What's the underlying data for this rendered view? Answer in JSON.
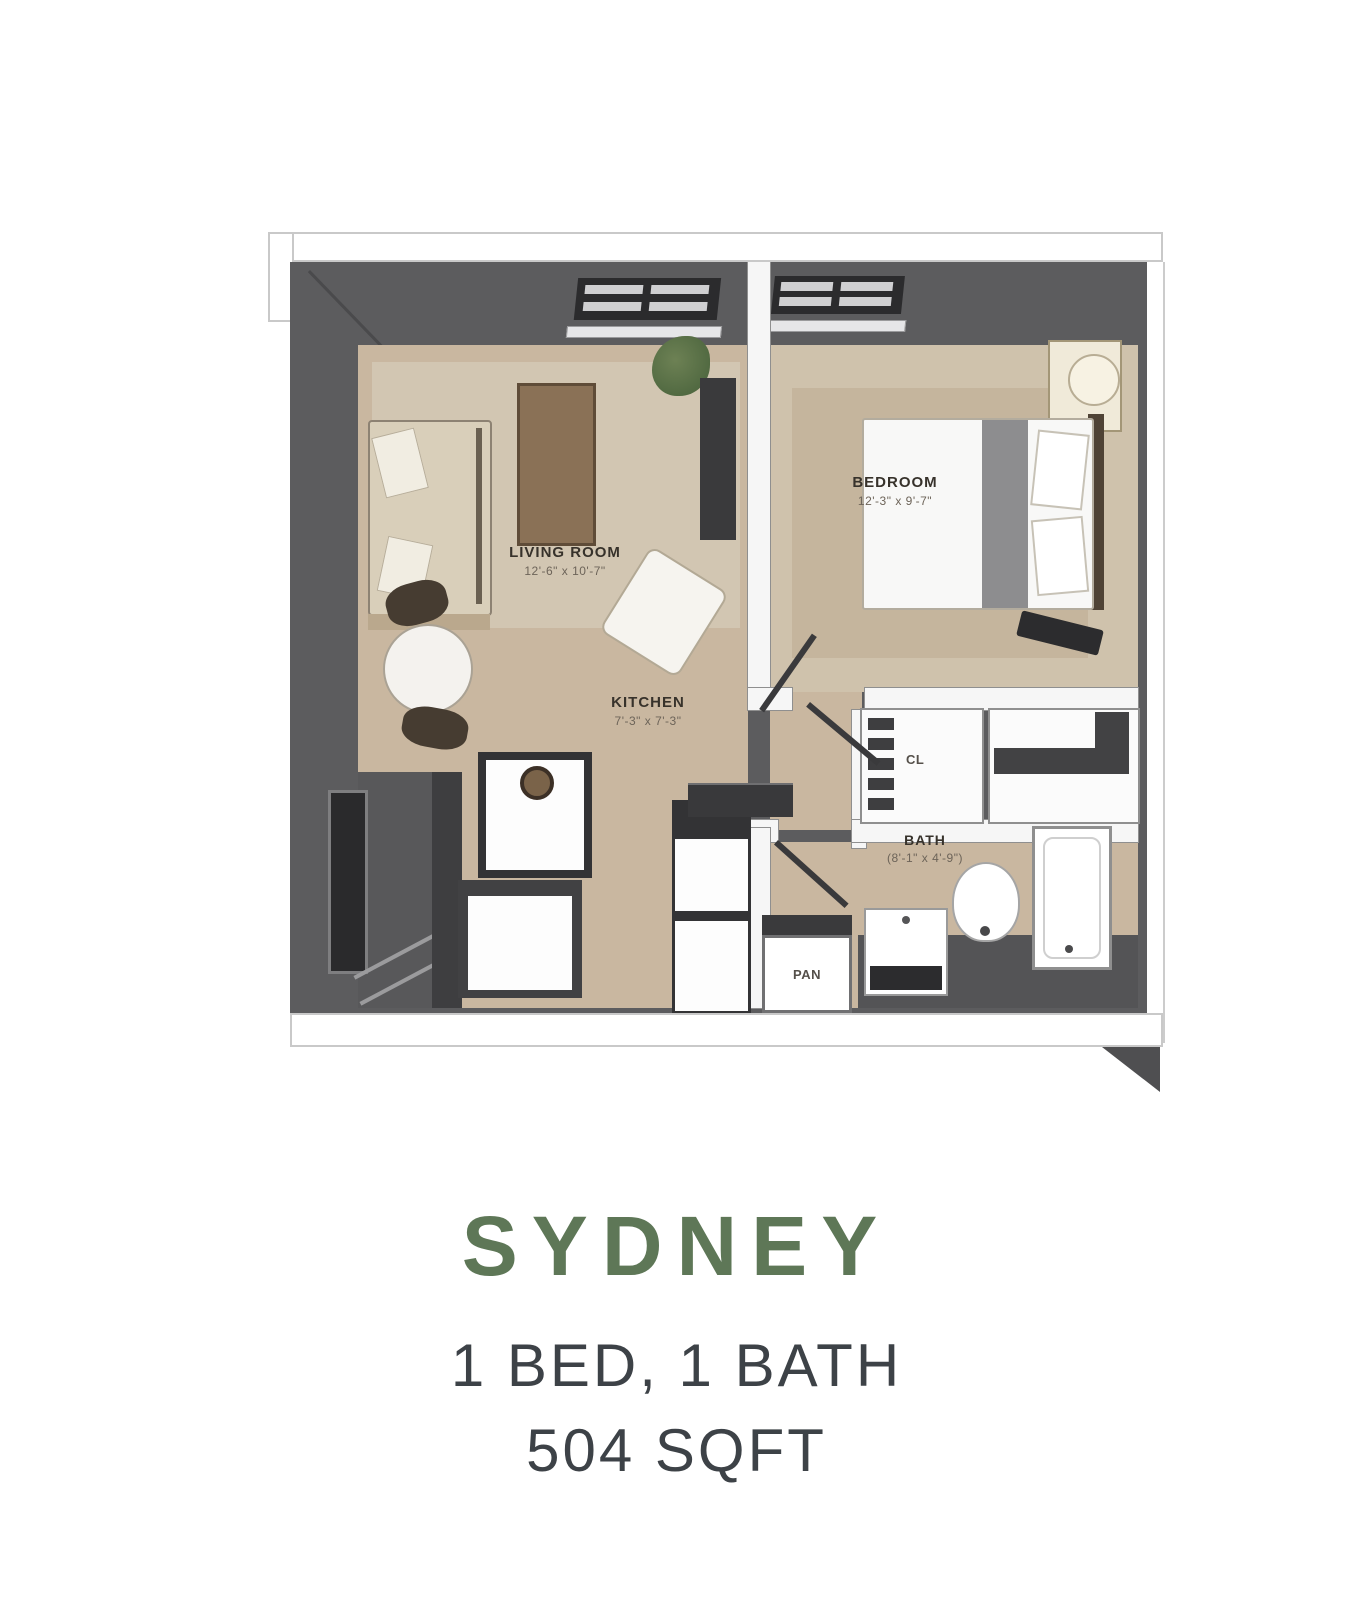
{
  "floor_plan": {
    "rooms": {
      "living_room": {
        "label": "LIVING ROOM",
        "dimensions": "12'-6\" x 10'-7\""
      },
      "bedroom": {
        "label": "BEDROOM",
        "dimensions": "12'-3\" x 9'-7\""
      },
      "kitchen": {
        "label": "KITCHEN",
        "dimensions": "7'-3\" x 7'-3\""
      },
      "bath": {
        "label": "BATH",
        "dimensions": "(8'-1\" x 4'-9\")"
      },
      "closet": {
        "label": "CL"
      },
      "pantry": {
        "label": "PAN"
      }
    }
  },
  "caption": {
    "name": "SYDNEY",
    "config": "1 BED, 1 BATH",
    "area": "504 SQFT"
  },
  "colors": {
    "title_green": "#5e7757",
    "text_dark": "#3d4247",
    "wall_gray": "#5c5c5e",
    "floor_tan": "#c9b7a0"
  }
}
